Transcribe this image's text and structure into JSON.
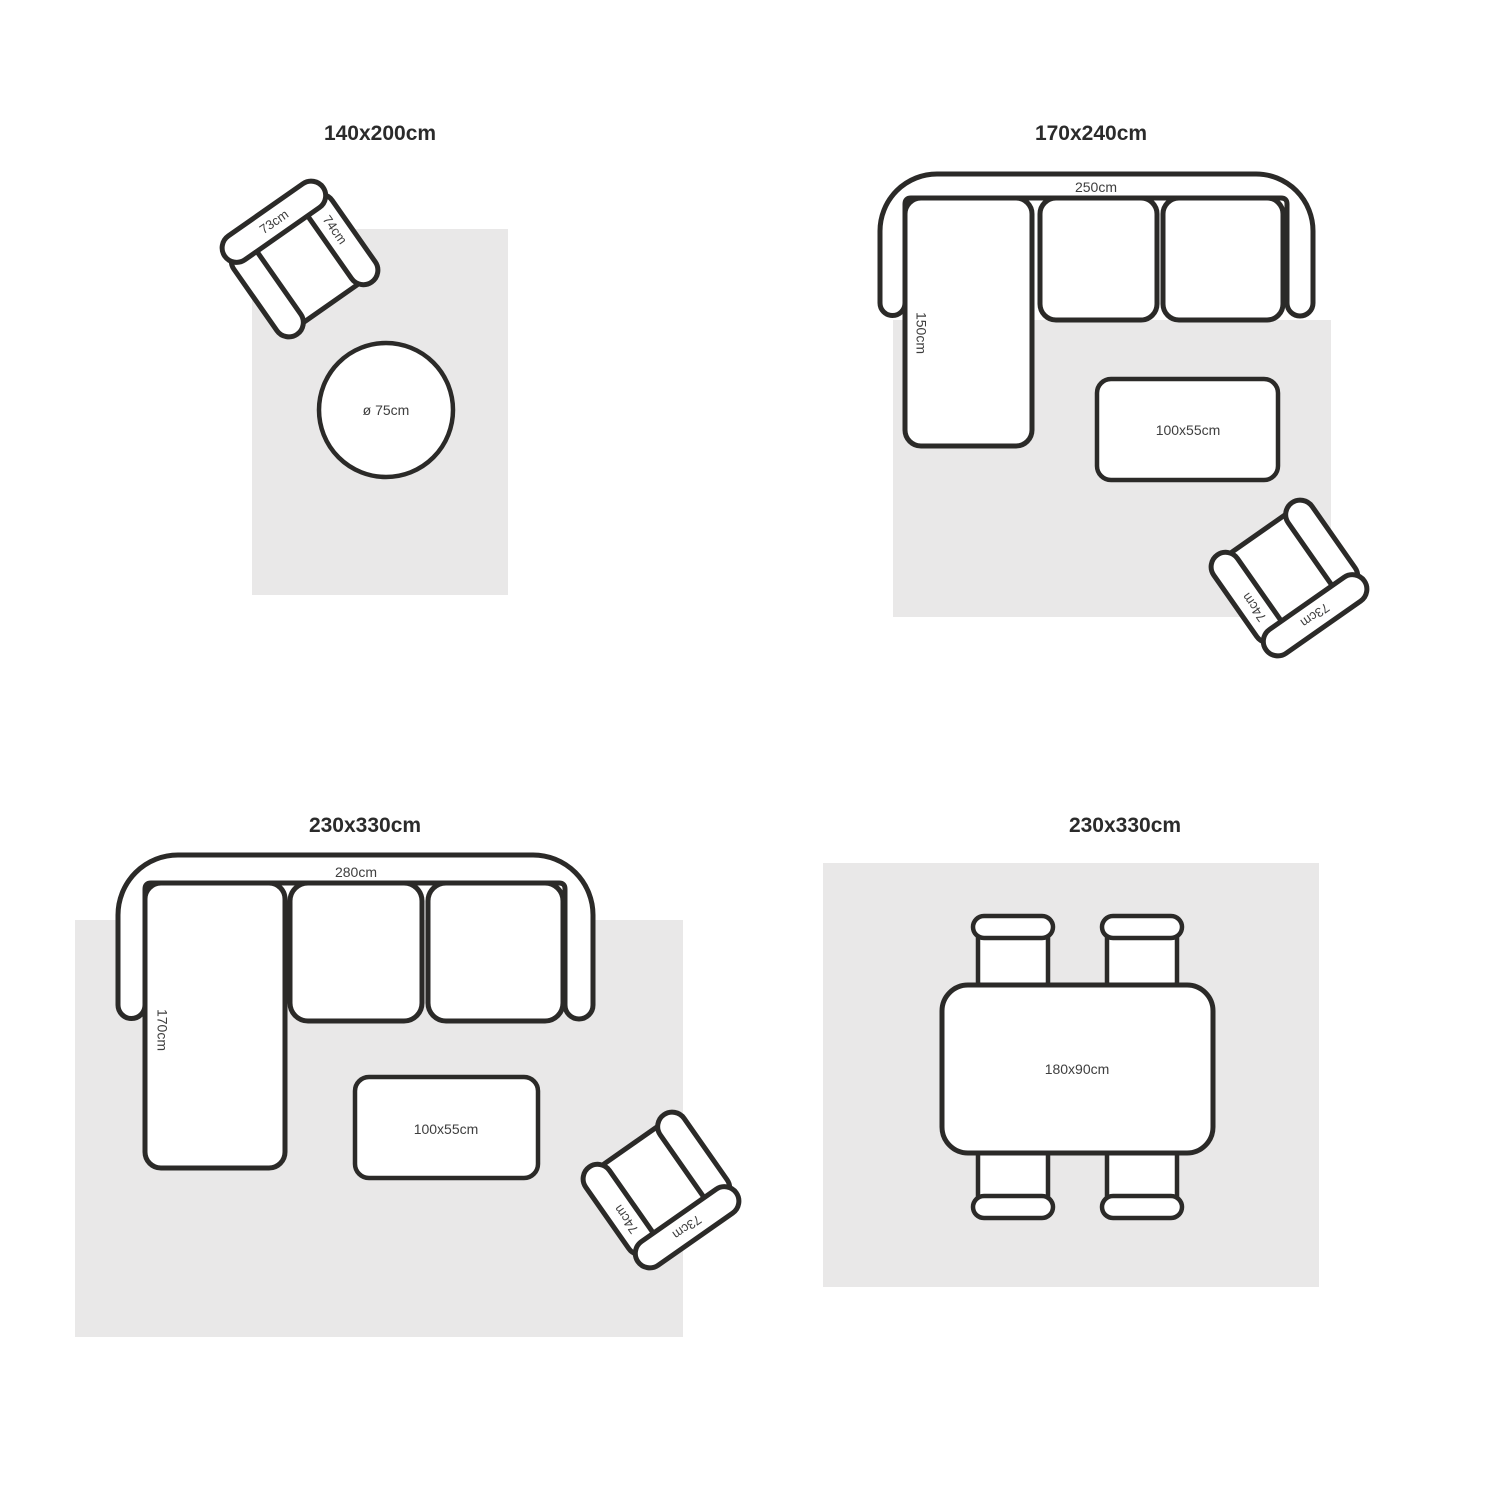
{
  "colors": {
    "background": "#ffffff",
    "rug_fill": "#e9e8e8",
    "outline": "#2b2a28",
    "title_text": "#2b2b2b",
    "dimension_text": "#3e3e3e"
  },
  "layouts": [
    {
      "title": "140x200cm",
      "armchair": {
        "back": "73cm",
        "arm": "74cm"
      },
      "round_table": {
        "label": "ø 75cm"
      }
    },
    {
      "title": "170x240cm",
      "sofa": {
        "width": "250cm",
        "depth": "150cm"
      },
      "coffee_table": {
        "label": "100x55cm"
      },
      "armchair": {
        "back": "73cm",
        "arm": "74cm"
      }
    },
    {
      "title": "230x330cm",
      "sofa": {
        "width": "280cm",
        "depth": "170cm"
      },
      "coffee_table": {
        "label": "100x55cm"
      },
      "armchair": {
        "back": "73cm",
        "arm": "74cm"
      }
    },
    {
      "title": "230x330cm",
      "dining_table": {
        "label": "180x90cm"
      }
    }
  ]
}
